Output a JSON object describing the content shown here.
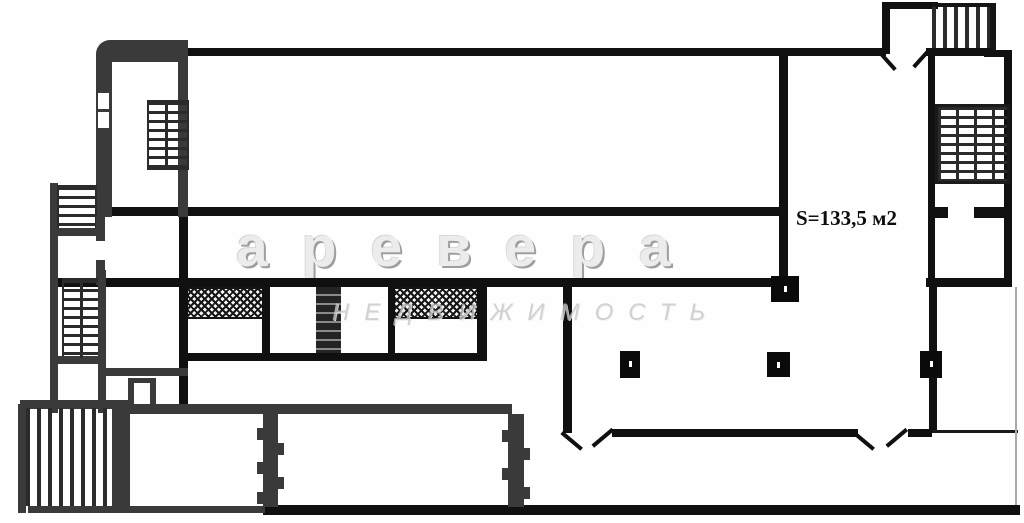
{
  "plan": {
    "area_label": "S=133,5 м2",
    "watermark": {
      "brand": "аревера",
      "subtitle": "НЕДВИЖИМОСТЬ"
    },
    "colors": {
      "wall_black": "#101010",
      "wall_gray": "#3a3a3a",
      "hatch": "#161616",
      "watermark_light": "#ececec",
      "watermark_shadow": "#9e9e9e",
      "watermark_subtitle": "#c6c6c6",
      "background": "#ffffff"
    },
    "regions": [
      "top-left-stairwell",
      "main-hall",
      "corridor",
      "sanitary-block",
      "left-stairwell",
      "bottom-left-stairwell",
      "retail-unit-133-5",
      "right-stairwell",
      "entrance-vestibule"
    ]
  }
}
